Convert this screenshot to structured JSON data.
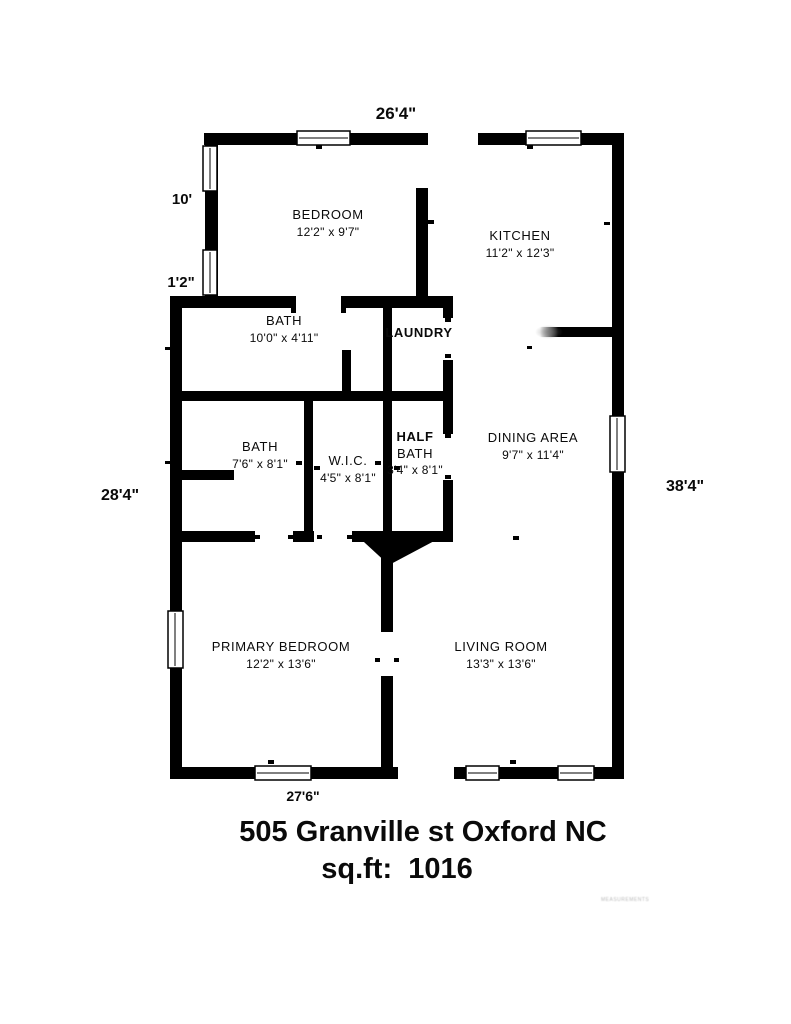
{
  "floorplan": {
    "exterior_dimensions": {
      "top": "26'4\"",
      "left_upper": "10'",
      "left_offset": "1'2\"",
      "left_lower": "28'4\"",
      "right": "38'4\"",
      "bottom": "27'6\""
    },
    "rooms": {
      "bedroom": {
        "name": "BEDROOM",
        "dims": "12'2\" x 9'7\""
      },
      "kitchen": {
        "name": "KITCHEN",
        "dims": "11'2\" x 12'3\""
      },
      "bath_main": {
        "name": "BATH",
        "dims": "10'0\" x 4'11\""
      },
      "laundry": {
        "name": "LAUNDRY"
      },
      "bath_second": {
        "name": "BATH",
        "dims": "7'6\" x 8'1\""
      },
      "wic": {
        "name": "W.I.C.",
        "dims": "4'5\" x 8'1\""
      },
      "half_bath": {
        "name_line1": "HALF",
        "name_line2": "BATH",
        "dims": "3'4\" x 8'1\""
      },
      "dining": {
        "name": "DINING AREA",
        "dims": "9'7\" x 11'4\""
      },
      "primary_bedroom": {
        "name": "PRIMARY BEDROOM",
        "dims": "12'2\" x 13'6\""
      },
      "living_room": {
        "name": "LIVING ROOM",
        "dims": "13'3\" x 13'6\""
      }
    },
    "footer": {
      "address": "505 Granville st Oxford NC",
      "sqft": "sq.ft:  1016"
    },
    "watermark": "MEASUREMENTS",
    "colors": {
      "wall": "#000000",
      "background": "#ffffff"
    }
  }
}
